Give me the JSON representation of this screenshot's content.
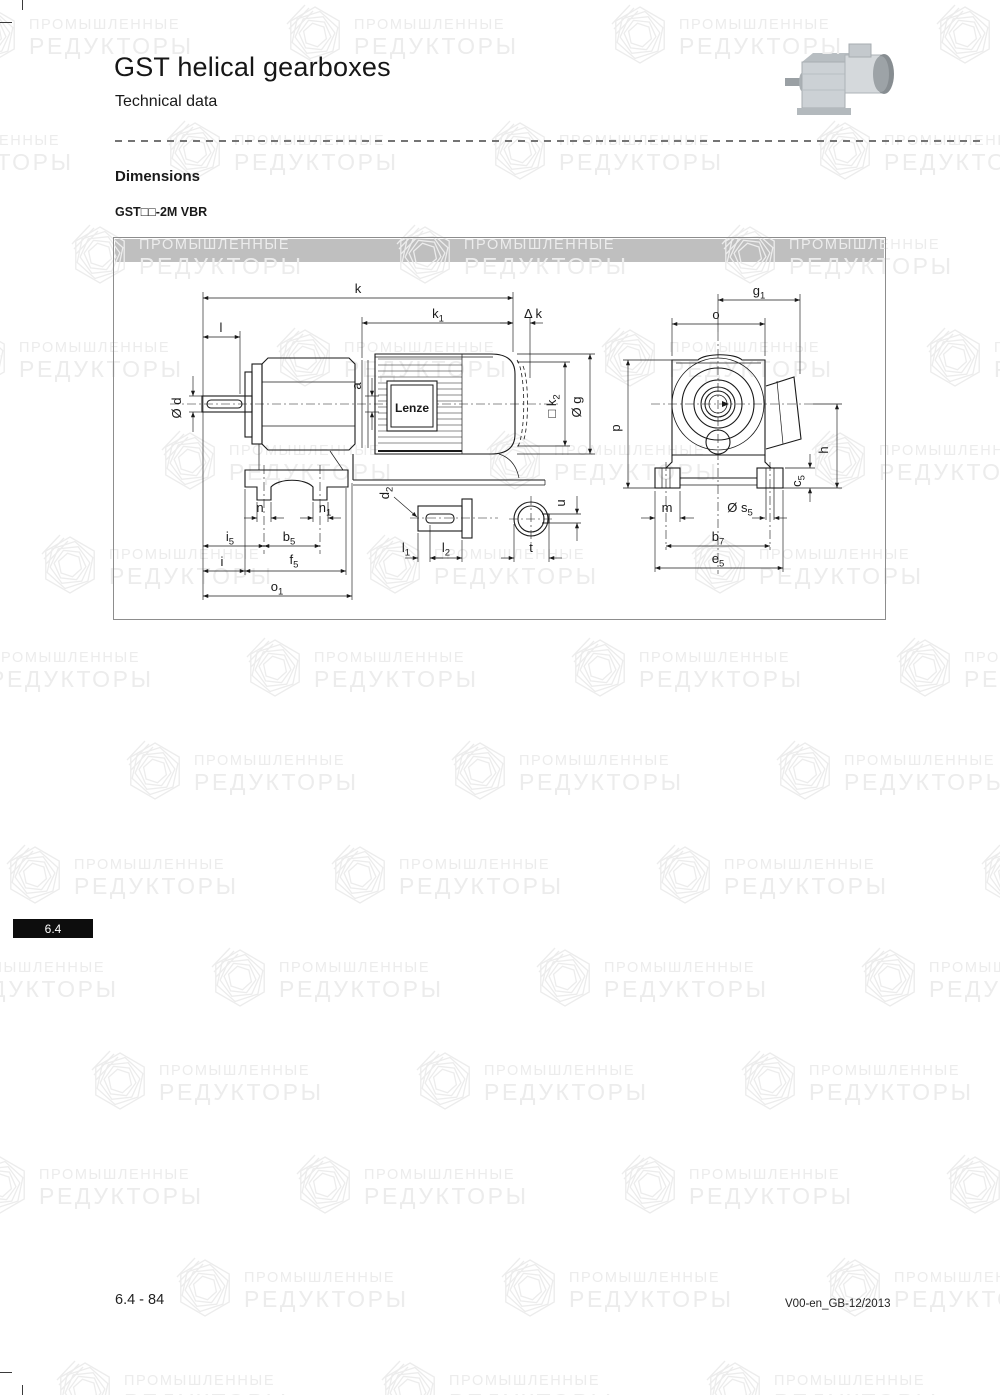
{
  "header": {
    "title": "GST helical gearboxes",
    "subtitle": "Technical data"
  },
  "section": {
    "heading": "Dimensions",
    "model": "GST□□-2M VBR"
  },
  "tab": {
    "label": "6.4"
  },
  "footer": {
    "page_number": "6.4 - 84",
    "doc_ref": "V00-en_GB-12/2013"
  },
  "watermark": {
    "line1": "ПРОМЫШЛЕННЫЕ",
    "line2": "РЕДУКТОРЫ"
  },
  "colors": {
    "panel_bar": "#bfbfbf",
    "watermark": "#ececec",
    "tab_bg": "#0d0d0d",
    "line": "#1a1a1a"
  },
  "drawing": {
    "logo": "Lenze",
    "labels": {
      "k": {
        "base": "k"
      },
      "k1": {
        "base": "k",
        "sub": "1"
      },
      "dk": {
        "base": "k",
        "prefix": "Δ "
      },
      "l": {
        "base": "l"
      },
      "d": {
        "base": "d",
        "prefix": "Ø "
      },
      "a": {
        "base": "a"
      },
      "k2": {
        "base": "k",
        "sub": "2",
        "prefix": "□ "
      },
      "g": {
        "base": "g",
        "prefix": "Ø "
      },
      "g1": {
        "base": "g",
        "sub": "1"
      },
      "o": {
        "base": "o"
      },
      "p": {
        "base": "p"
      },
      "h": {
        "base": "h"
      },
      "c5": {
        "base": "c",
        "sub": "5"
      },
      "m": {
        "base": "m"
      },
      "s5": {
        "base": "s",
        "sub": "5",
        "prefix": "Ø "
      },
      "b7": {
        "base": "b",
        "sub": "7"
      },
      "e5": {
        "base": "e",
        "sub": "5"
      },
      "n": {
        "base": "n"
      },
      "n1": {
        "base": "n",
        "sub": "1"
      },
      "i5": {
        "base": "i",
        "sub": "5"
      },
      "b5": {
        "base": "b",
        "sub": "5"
      },
      "i": {
        "base": "i"
      },
      "f5": {
        "base": "f",
        "sub": "5"
      },
      "o1": {
        "base": "o",
        "sub": "1"
      },
      "d2": {
        "base": "d",
        "sub": "2"
      },
      "l1": {
        "base": "l",
        "sub": "1"
      },
      "l2": {
        "base": "l",
        "sub": "2"
      },
      "u": {
        "base": "u"
      },
      "t": {
        "base": "t"
      }
    }
  }
}
